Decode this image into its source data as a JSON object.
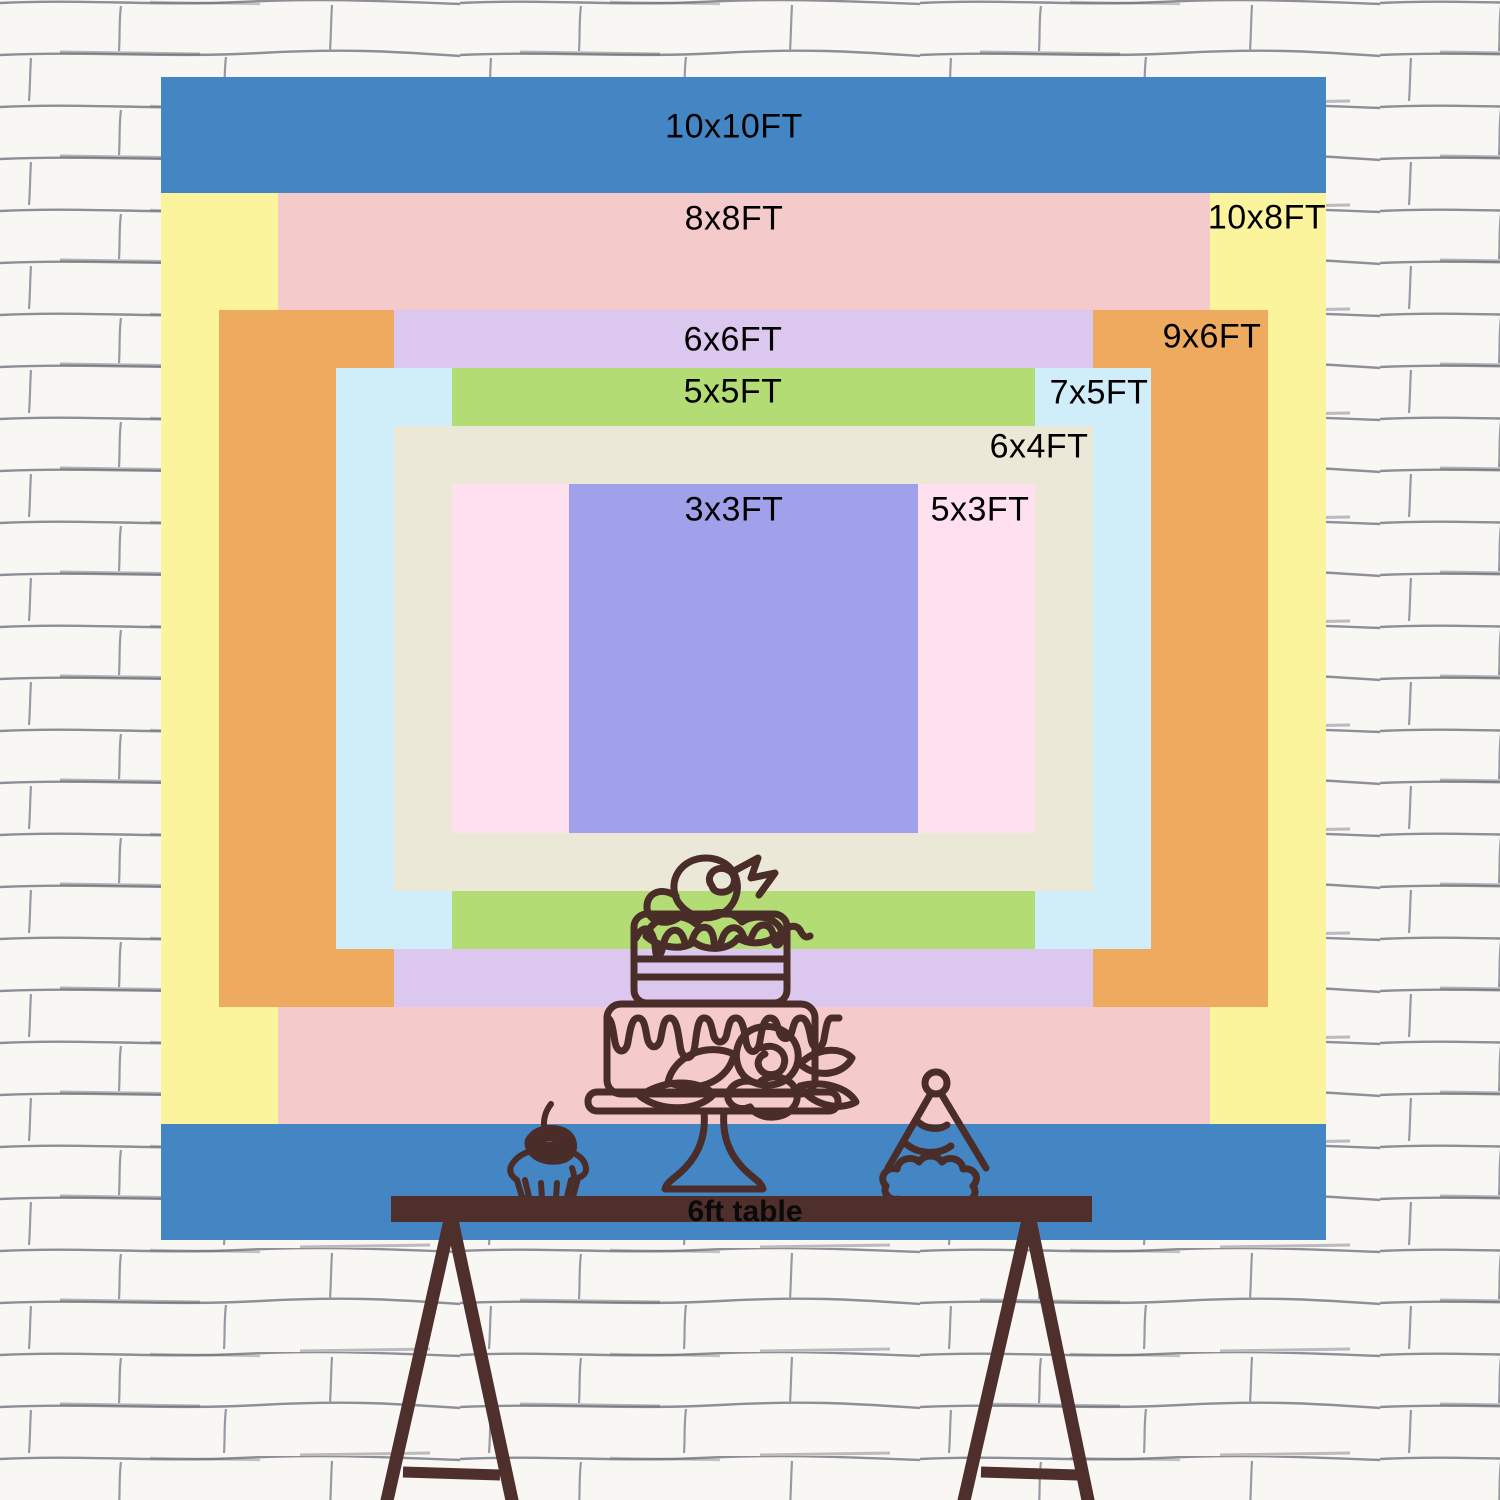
{
  "page": {
    "description": "Backdrop size comparison chart with nested rectangles on a white brick wall, party table illustration below"
  },
  "backdrop": {
    "left": 161,
    "top": 77,
    "width": 1165,
    "height": 1163,
    "ft_width": 10,
    "ft_height": 10
  },
  "sizes": [
    {
      "label": "10x10FT",
      "ft_w": 10,
      "ft_h": 10,
      "color": "#4486c4",
      "label_x": 734,
      "label_y": 127
    },
    {
      "label": "10x8FT",
      "ft_w": 10,
      "ft_h": 8,
      "color": "#fcf49c",
      "label_x": 1267,
      "label_y": 218
    },
    {
      "label": "8x8FT",
      "ft_w": 8,
      "ft_h": 8,
      "color": "#f5caca",
      "label_x": 734,
      "label_y": 219
    },
    {
      "label": "9x6FT",
      "ft_w": 9,
      "ft_h": 6,
      "color": "#eeab60",
      "label_x": 1212,
      "label_y": 337
    },
    {
      "label": "6x6FT",
      "ft_w": 6,
      "ft_h": 6,
      "color": "#dcc8ef",
      "label_x": 733,
      "label_y": 340
    },
    {
      "label": "7x5FT",
      "ft_w": 7,
      "ft_h": 5,
      "color": "#cfeef9",
      "label_x": 1099,
      "label_y": 393
    },
    {
      "label": "5x5FT",
      "ft_w": 5,
      "ft_h": 5,
      "color": "#b4dc74",
      "label_x": 733,
      "label_y": 392
    },
    {
      "label": "6x4FT",
      "ft_w": 6,
      "ft_h": 4,
      "color": "#ece8d8",
      "label_x": 1039,
      "label_y": 447
    },
    {
      "label": "5x3FT",
      "ft_w": 5,
      "ft_h": 3,
      "color": "#fee0f0",
      "label_x": 980,
      "label_y": 510
    },
    {
      "label": "3x3FT",
      "ft_w": 3,
      "ft_h": 3,
      "color": "#a0a1ea",
      "label_x": 734,
      "label_y": 510
    }
  ],
  "label_text_color": "#000000",
  "table": {
    "label": "6ft table",
    "bar_color": "#4e2f2b",
    "text_color": "#0a0a0a"
  },
  "artwork": {
    "line_color": "#4a2c28",
    "icons": [
      "cake-icon",
      "cupcake-icon",
      "party-hat-icon"
    ]
  },
  "wall": {
    "bg": "#f8f7f4",
    "line_color": "#8d8e96",
    "accent_line_color": "#60616b"
  }
}
